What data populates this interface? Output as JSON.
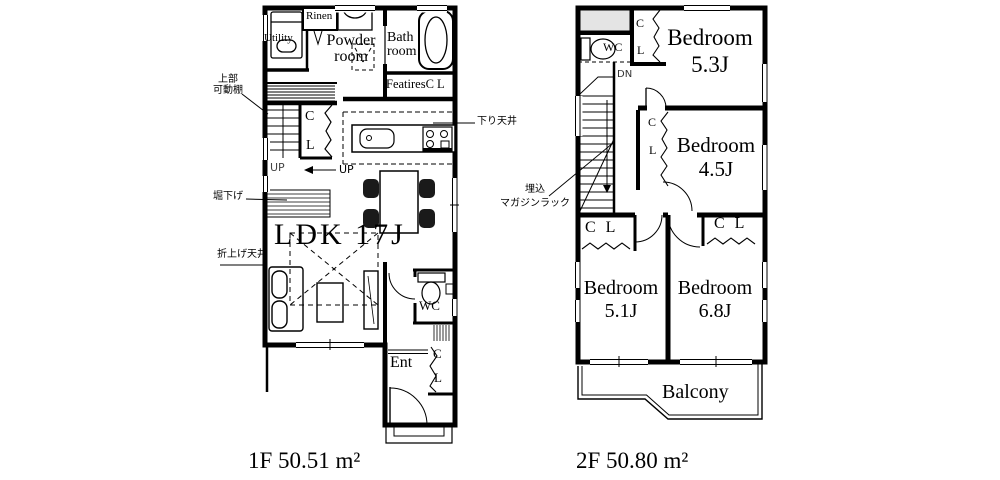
{
  "floor1": {
    "caption": "1F 50.51 m²",
    "labels": {
      "utility": "Utility",
      "rinen": "Rinen",
      "powder_line1": "Powder",
      "powder_line2": "room",
      "bath_line1": "Bath",
      "bath_line2": "room",
      "featires_cl": "FeatiresC L",
      "closet_c": "C",
      "closet_l": "L",
      "up_stairs": "UP",
      "up_arrow": "UP",
      "ldk": "LDK 17J",
      "wc": "WC",
      "ent": "Ent",
      "ent_closet_c": "C",
      "ent_closet_l": "L"
    },
    "annotations": {
      "upper_shelf_line1": "上部",
      "upper_shelf_line2": "可動棚",
      "dug_down": "堀下げ",
      "raised_ceiling": "折上げ天井",
      "lowered_ceiling": "下り天井"
    }
  },
  "floor2": {
    "caption": "2F 50.80 m²",
    "labels": {
      "wc": "WC",
      "dn": "DN",
      "closet_top_c": "C",
      "closet_top_l": "L",
      "closet45_c": "C",
      "closet45_l": "L",
      "closet51": "C L",
      "closet68": "C L",
      "bedroom53_name": "Bedroom",
      "bedroom53_size": "5.3J",
      "bedroom45_name": "Bedroom",
      "bedroom45_size": "4.5J",
      "bedroom51_name": "Bedroom",
      "bedroom51_size": "5.1J",
      "bedroom68_name": "Bedroom",
      "bedroom68_size": "6.8J",
      "balcony": "Balcony"
    },
    "annotations": {
      "magazine_line1": "埋込",
      "magazine_line2": "マガジンラック"
    }
  },
  "colors": {
    "wall": "#000000",
    "background": "#ffffff",
    "roof_shade": "#e4e4e4"
  }
}
